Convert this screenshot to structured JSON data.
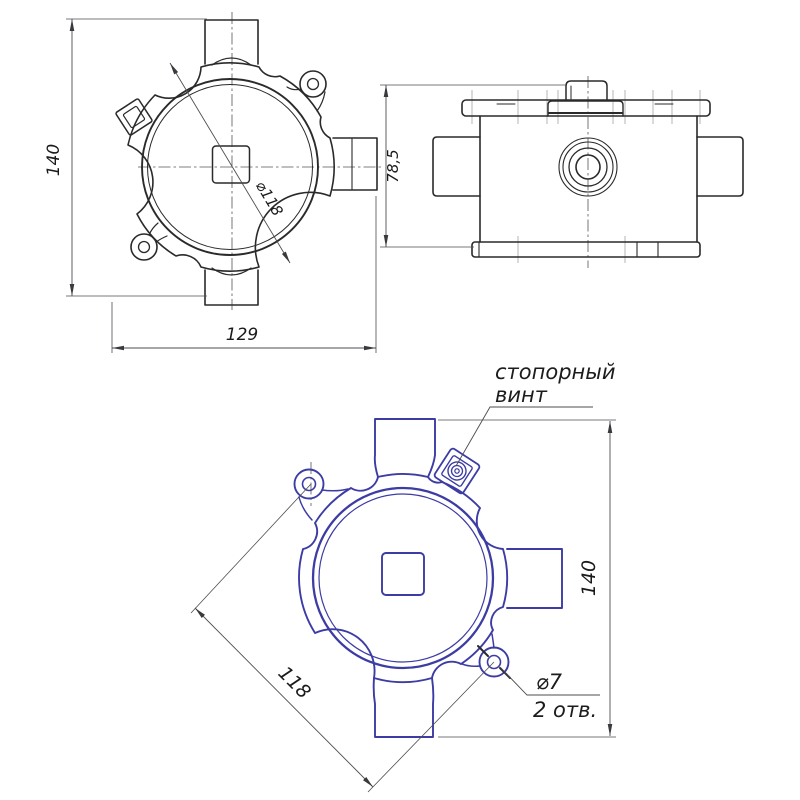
{
  "meta": {
    "background": "#ffffff",
    "ink_color": "#2a2a2a",
    "accent_blue": "#3c3ca4",
    "dim_color": "#4d4d52"
  },
  "front_view": {
    "dim_height": "140",
    "dim_width": "129",
    "dim_diameter": "⌀118"
  },
  "side_view": {
    "dim_height": "78,5"
  },
  "back_view": {
    "dim_height": "140",
    "dim_hole_spacing": "118",
    "hole_callout": {
      "diameter": "⌀7",
      "count": "2 отв."
    },
    "screw_callout": {
      "line1": "стопорный",
      "line2": "винт"
    }
  }
}
